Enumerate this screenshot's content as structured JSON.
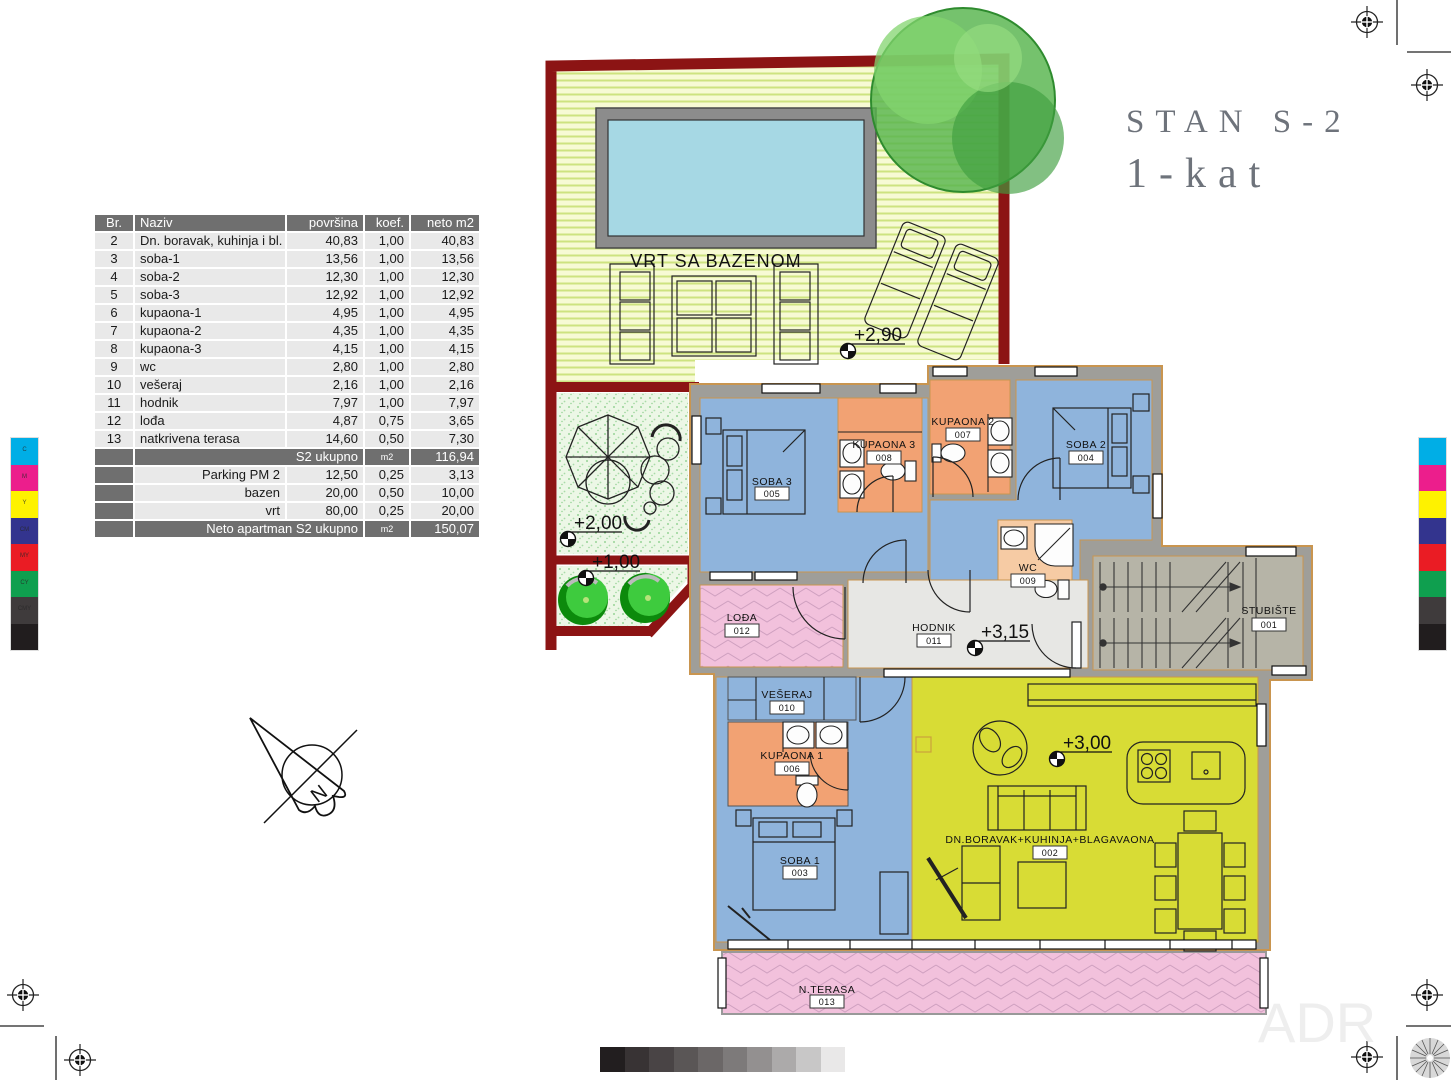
{
  "title": {
    "line1": "STAN S-2",
    "line2": "1-kat"
  },
  "table": {
    "headers": [
      "Br.",
      "Naziv",
      "površina",
      "koef.",
      "neto m2"
    ],
    "rows": [
      [
        "2",
        "Dn. boravak, kuhinja i bl.",
        "40,83",
        "1,00",
        "40,83"
      ],
      [
        "3",
        "soba-1",
        "13,56",
        "1,00",
        "13,56"
      ],
      [
        "4",
        "soba-2",
        "12,30",
        "1,00",
        "12,30"
      ],
      [
        "5",
        "soba-3",
        "12,92",
        "1,00",
        "12,92"
      ],
      [
        "6",
        "kupaona-1",
        "4,95",
        "1,00",
        "4,95"
      ],
      [
        "7",
        "kupaona-2",
        "4,35",
        "1,00",
        "4,35"
      ],
      [
        "8",
        "kupaona-3",
        "4,15",
        "1,00",
        "4,15"
      ],
      [
        "9",
        "wc",
        "2,80",
        "1,00",
        "2,80"
      ],
      [
        "10",
        "vešeraj",
        "2,16",
        "1,00",
        "2,16"
      ],
      [
        "11",
        "hodnik",
        "7,97",
        "1,00",
        "7,97"
      ],
      [
        "12",
        "lođa",
        "4,87",
        "0,75",
        "3,65"
      ],
      [
        "13",
        "natkrivena terasa",
        "14,60",
        "0,50",
        "7,30"
      ]
    ],
    "subtotal": {
      "label": "S2 ukupno",
      "unit": "m2",
      "value": "116,94"
    },
    "extras": [
      [
        "Parking PM 2",
        "12,50",
        "0,25",
        "3,13"
      ],
      [
        "bazen",
        "20,00",
        "0,50",
        "10,00"
      ],
      [
        "vrt",
        "80,00",
        "0,25",
        "20,00"
      ]
    ],
    "total": {
      "label": "Neto apartman S2 ukupno",
      "unit": "m2",
      "value": "150,07"
    }
  },
  "plan": {
    "garden_label": "VRT SA BAZENOM",
    "north_label": "N",
    "watermark": "ADR",
    "rooms": [
      {
        "name": "SOBA 3",
        "number": "005"
      },
      {
        "name": "KUPAONA 3",
        "number": "008"
      },
      {
        "name": "KUPAONA 2",
        "number": "007"
      },
      {
        "name": "SOBA 2",
        "number": "004"
      },
      {
        "name": "WC",
        "number": "009"
      },
      {
        "name": "STUBIŠTE",
        "number": "001"
      },
      {
        "name": "LOĐA",
        "number": "012"
      },
      {
        "name": "HODNIK",
        "number": "011"
      },
      {
        "name": "VEŠERAJ",
        "number": "010"
      },
      {
        "name": "KUPAONA 1",
        "number": "006"
      },
      {
        "name": "SOBA 1",
        "number": "003"
      },
      {
        "name": "DN.BORAVAK+KUHINJA+BLAGAVAONA",
        "number": "002"
      },
      {
        "name": "N.TERASA",
        "number": "013"
      }
    ],
    "elevations": [
      "+2,90",
      "+2,00",
      "+1,00",
      "+3,15",
      "+3,00"
    ]
  },
  "colors": {
    "wall_red": "#8c1414",
    "wall_gray": "#9f9e99",
    "wall_trim": "#c9954f",
    "room_blue": "#8fb4dc",
    "room_orange": "#f2a273",
    "room_peach": "#f6cba4",
    "room_yellow": "#d8dc35",
    "room_pink": "#f2c1dc",
    "stair_gray": "#b6b4a7",
    "hall_gray": "#e7e7e4",
    "pool_water": "#a6d8e4",
    "pool_frame": "#8c8c8c",
    "garden_stripe": "#cde37f",
    "garden_stipple": "#ecf7e6",
    "tree_green": "#57b44d"
  },
  "print_marks": {
    "color_bar": [
      {
        "label": "C",
        "hex": "#00aee6"
      },
      {
        "label": "M",
        "hex": "#ec1e8c"
      },
      {
        "label": "Y",
        "hex": "#fef200"
      },
      {
        "label": "CM",
        "hex": "#33348e"
      },
      {
        "label": "MY",
        "hex": "#ea1c24"
      },
      {
        "label": "CY",
        "hex": "#0f9f4f"
      },
      {
        "label": "CMY",
        "hex": "#3f3b3c"
      },
      {
        "label": "",
        "hex": "#211d1e"
      }
    ],
    "gray_bar": [
      "#221e1f",
      "#383334",
      "#494445",
      "#5a5656",
      "#6b6767",
      "#7d7a7a",
      "#939090",
      "#acaaaa",
      "#c8c7c7",
      "#e9e8e8"
    ]
  }
}
